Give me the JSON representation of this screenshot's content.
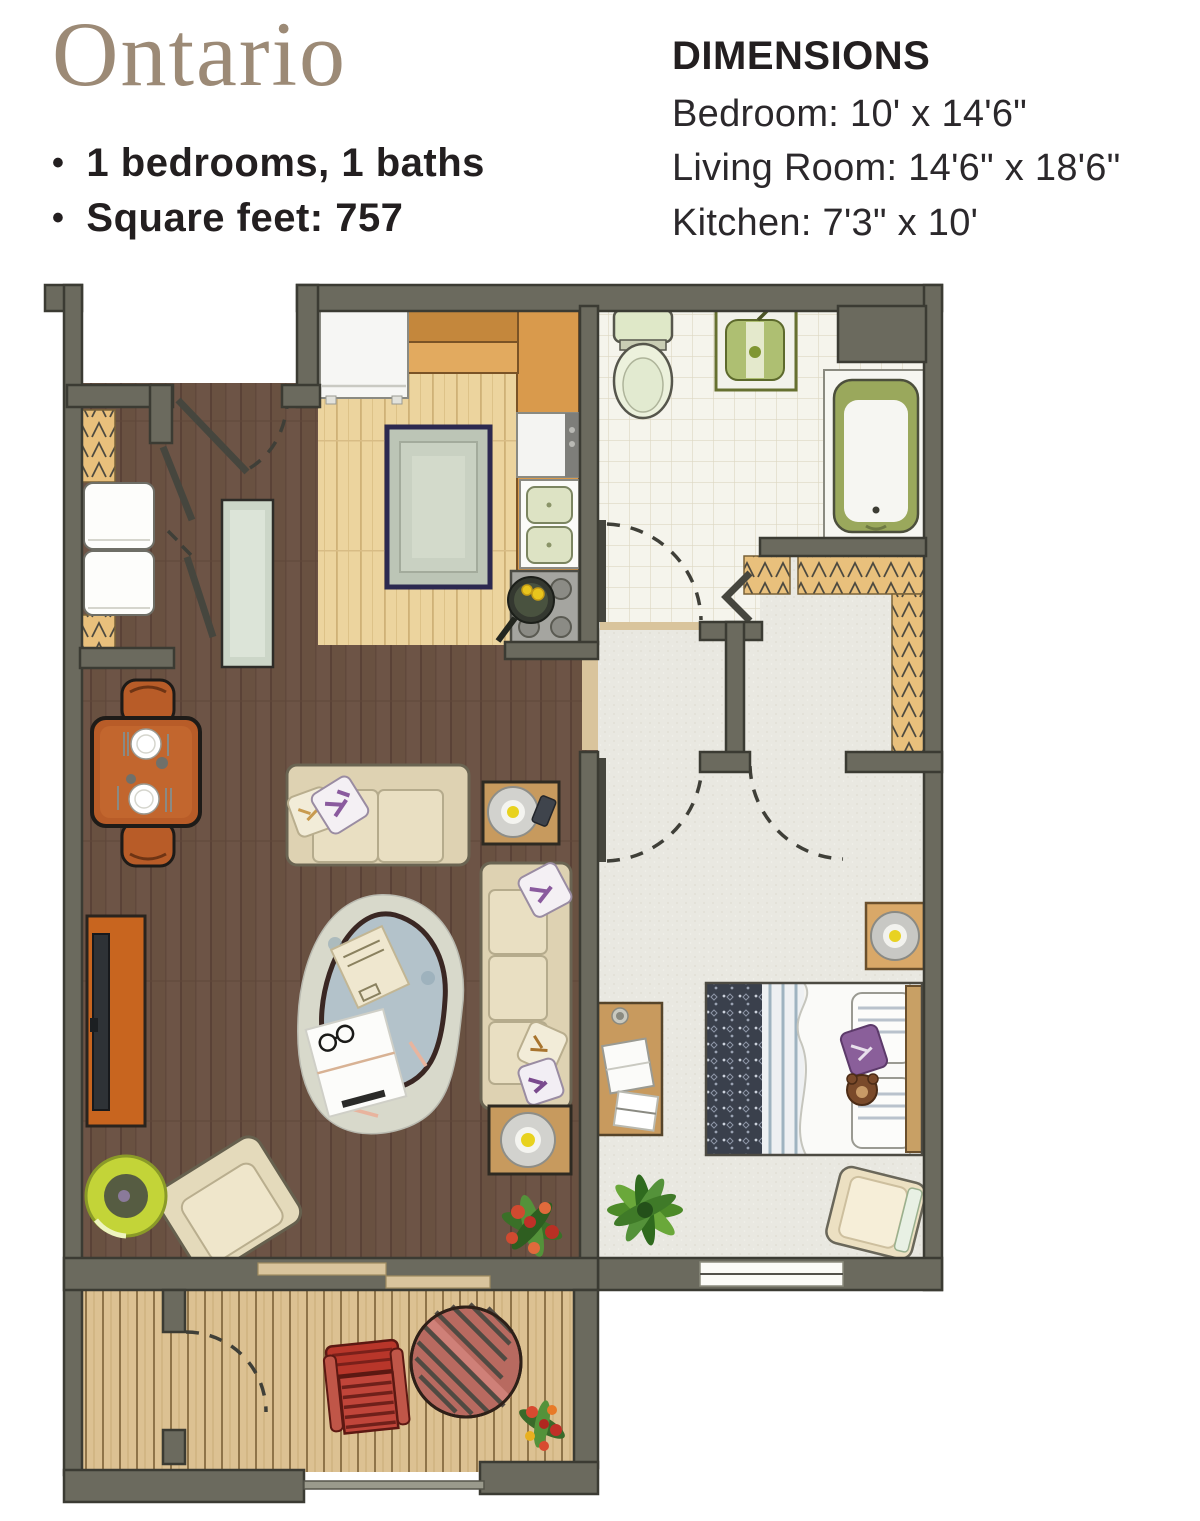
{
  "header": {
    "title": "Ontario",
    "bullets": [
      "1 bedrooms, 1 baths",
      "Square feet: 757"
    ]
  },
  "dimensions": {
    "heading": "DIMENSIONS",
    "items": [
      "Bedroom: 10' x 14'6\"",
      "Living Room: 14'6\" x 18'6\"",
      "Kitchen: 7'3\" x 10'"
    ]
  },
  "colors": {
    "title_text": "#9c8a76",
    "body_text": "#231f20",
    "wall": "#6b6a5e",
    "wall_outline": "#3b3b33",
    "wood_dark": "#6d5446",
    "wood_light": "#ecd49e",
    "deck": "#dcc192",
    "tile": "#f5f4ec",
    "carpet": "#e9e8e1",
    "shelf": "#e9c07c",
    "terracotta": "#b85c28",
    "sofa_beige": "#e9dfc2",
    "rug_navy": "#2c2950",
    "fixture_green": "#aebf72",
    "threshold": "#d9c49c"
  }
}
